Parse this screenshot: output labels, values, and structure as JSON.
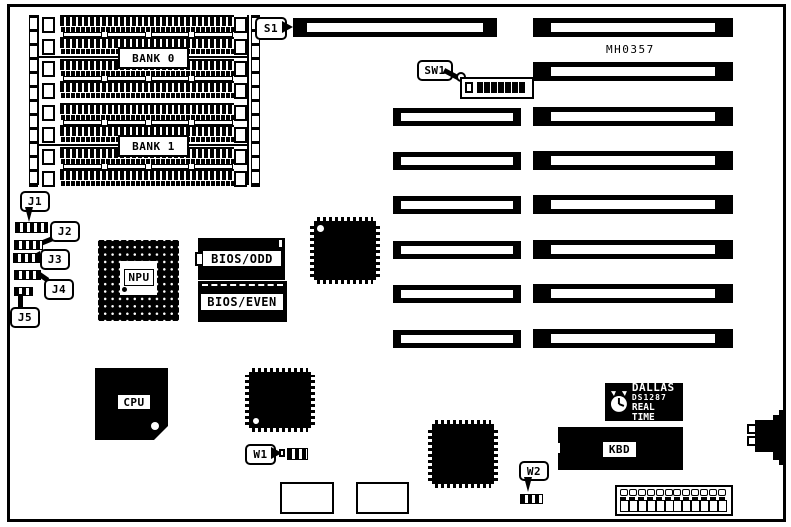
{
  "colors": {
    "ink": "#000000",
    "paper": "#ffffff"
  },
  "annotations": {
    "part_number": "MH0357"
  },
  "memory": {
    "bank0": "BANK 0",
    "bank1": "BANK 1"
  },
  "callouts": {
    "s1": "S1",
    "sw1": "SW1",
    "j1": "J1",
    "j2": "J2",
    "j3": "J3",
    "j4": "J4",
    "j5": "J5",
    "w1": "W1",
    "w2": "W2"
  },
  "chips": {
    "npu": "NPU",
    "bios_odd": "BIOS/ODD",
    "bios_even": "BIOS/EVEN",
    "cpu": "CPU",
    "kbd": "KBD"
  },
  "rtc": {
    "brand": "DALLAS",
    "model": "DS1287",
    "label": "REAL TIME"
  },
  "icons": {
    "rtc_logo": "clock-icon"
  }
}
